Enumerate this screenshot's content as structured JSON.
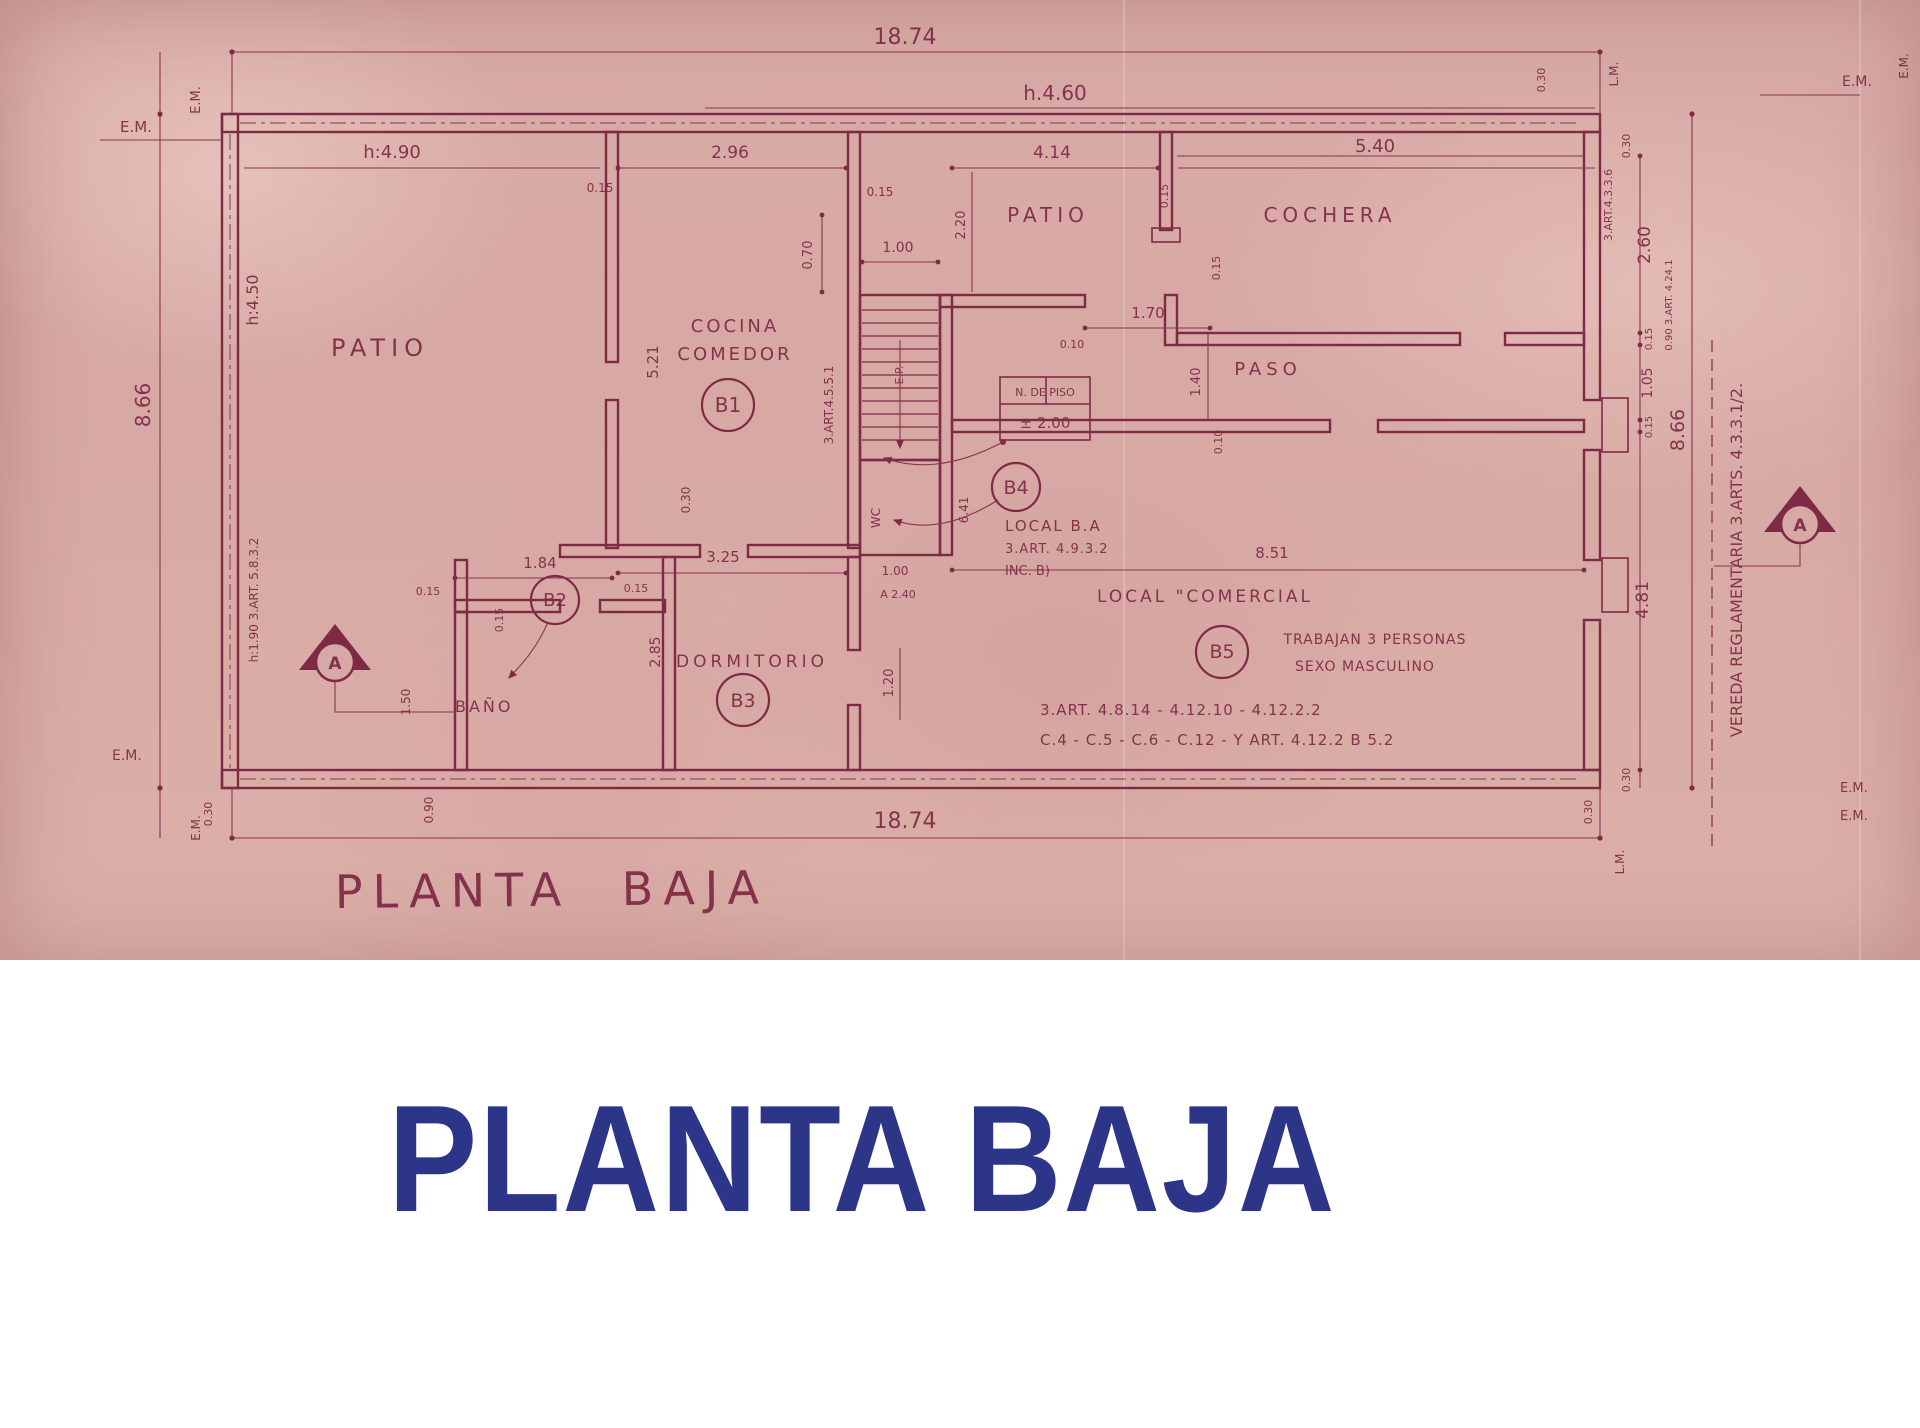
{
  "title": {
    "text": "PLANTA BAJA"
  },
  "colors": {
    "paper": "#d7a9a4",
    "ink": "#7e2a45",
    "title_blue": "#2c3587"
  },
  "plan": {
    "handwritten_title": "PLANTA BAJA",
    "markers": {
      "em": "E.M.",
      "lm": "L.M.",
      "section": "A"
    },
    "rooms": {
      "patio_left": "PATIO",
      "cocina_line1": "COCINA",
      "cocina_line2": "COMEDOR",
      "patio_center": "PATIO",
      "cochera": "COCHERA",
      "paso": "PASO",
      "dormitorio": "DORMITORIO",
      "bano": "BAÑO"
    },
    "units": {
      "b1": "B1",
      "b2": "B2",
      "b3": "B3",
      "b4": "B4",
      "b5": "B5"
    },
    "dims": {
      "total_width": "18.74",
      "h460": "h.4.60",
      "h490": "h:4.90",
      "w296": "2.96",
      "w414": "4.14",
      "w540": "5.40",
      "t015": "0.15",
      "t030": "0.30",
      "t010": "0.10",
      "h866": "8.66",
      "h450": "h:4.50",
      "note_h190": "h:1.90 3.ART. 5.8.3.2",
      "d521": "5.21",
      "d325": "3.25",
      "d184": "1.84",
      "d285": "2.85",
      "d150": "1.50",
      "d120": "1.20",
      "d100": "1.00",
      "d070": "0.70",
      "d220": "2.20",
      "d170": "1.70",
      "d140": "1.40",
      "d105": "1.05",
      "d260": "2.60",
      "d481": "4.81",
      "d851": "8.51",
      "d641": "6.41",
      "d090": "0.90",
      "a240": "A 2.40"
    },
    "annotations": {
      "stair_art": "3.ART.4.5.5.1",
      "ep": "E.P.",
      "wc": "WC",
      "nivel_line1": "N. DE PISO",
      "nivel_line2": "± 2.00",
      "art4336": "3.ART.4.3.3.6",
      "art4241": "0.90 3.ART. 4.24.1",
      "vereda": "VEREDA REGLAMENTARIA 3.ARTS. 4.3.3.1/2.",
      "local_ba_1": "LOCAL B.A",
      "local_ba_2": "3.ART. 4.9.3.2",
      "local_ba_3": "INC. B)",
      "local_com": "LOCAL \"COMERCIAL",
      "trabajan": "TRABAJAN 3 PERSONAS",
      "sexo": "SEXO MASCULINO",
      "arts_1": "3.ART. 4.8.14 - 4.12.10 - 4.12.2.2",
      "arts_2": "C.4 - C.5 - C.6 - C.12 - Y ART. 4.12.2 B 5.2"
    }
  }
}
